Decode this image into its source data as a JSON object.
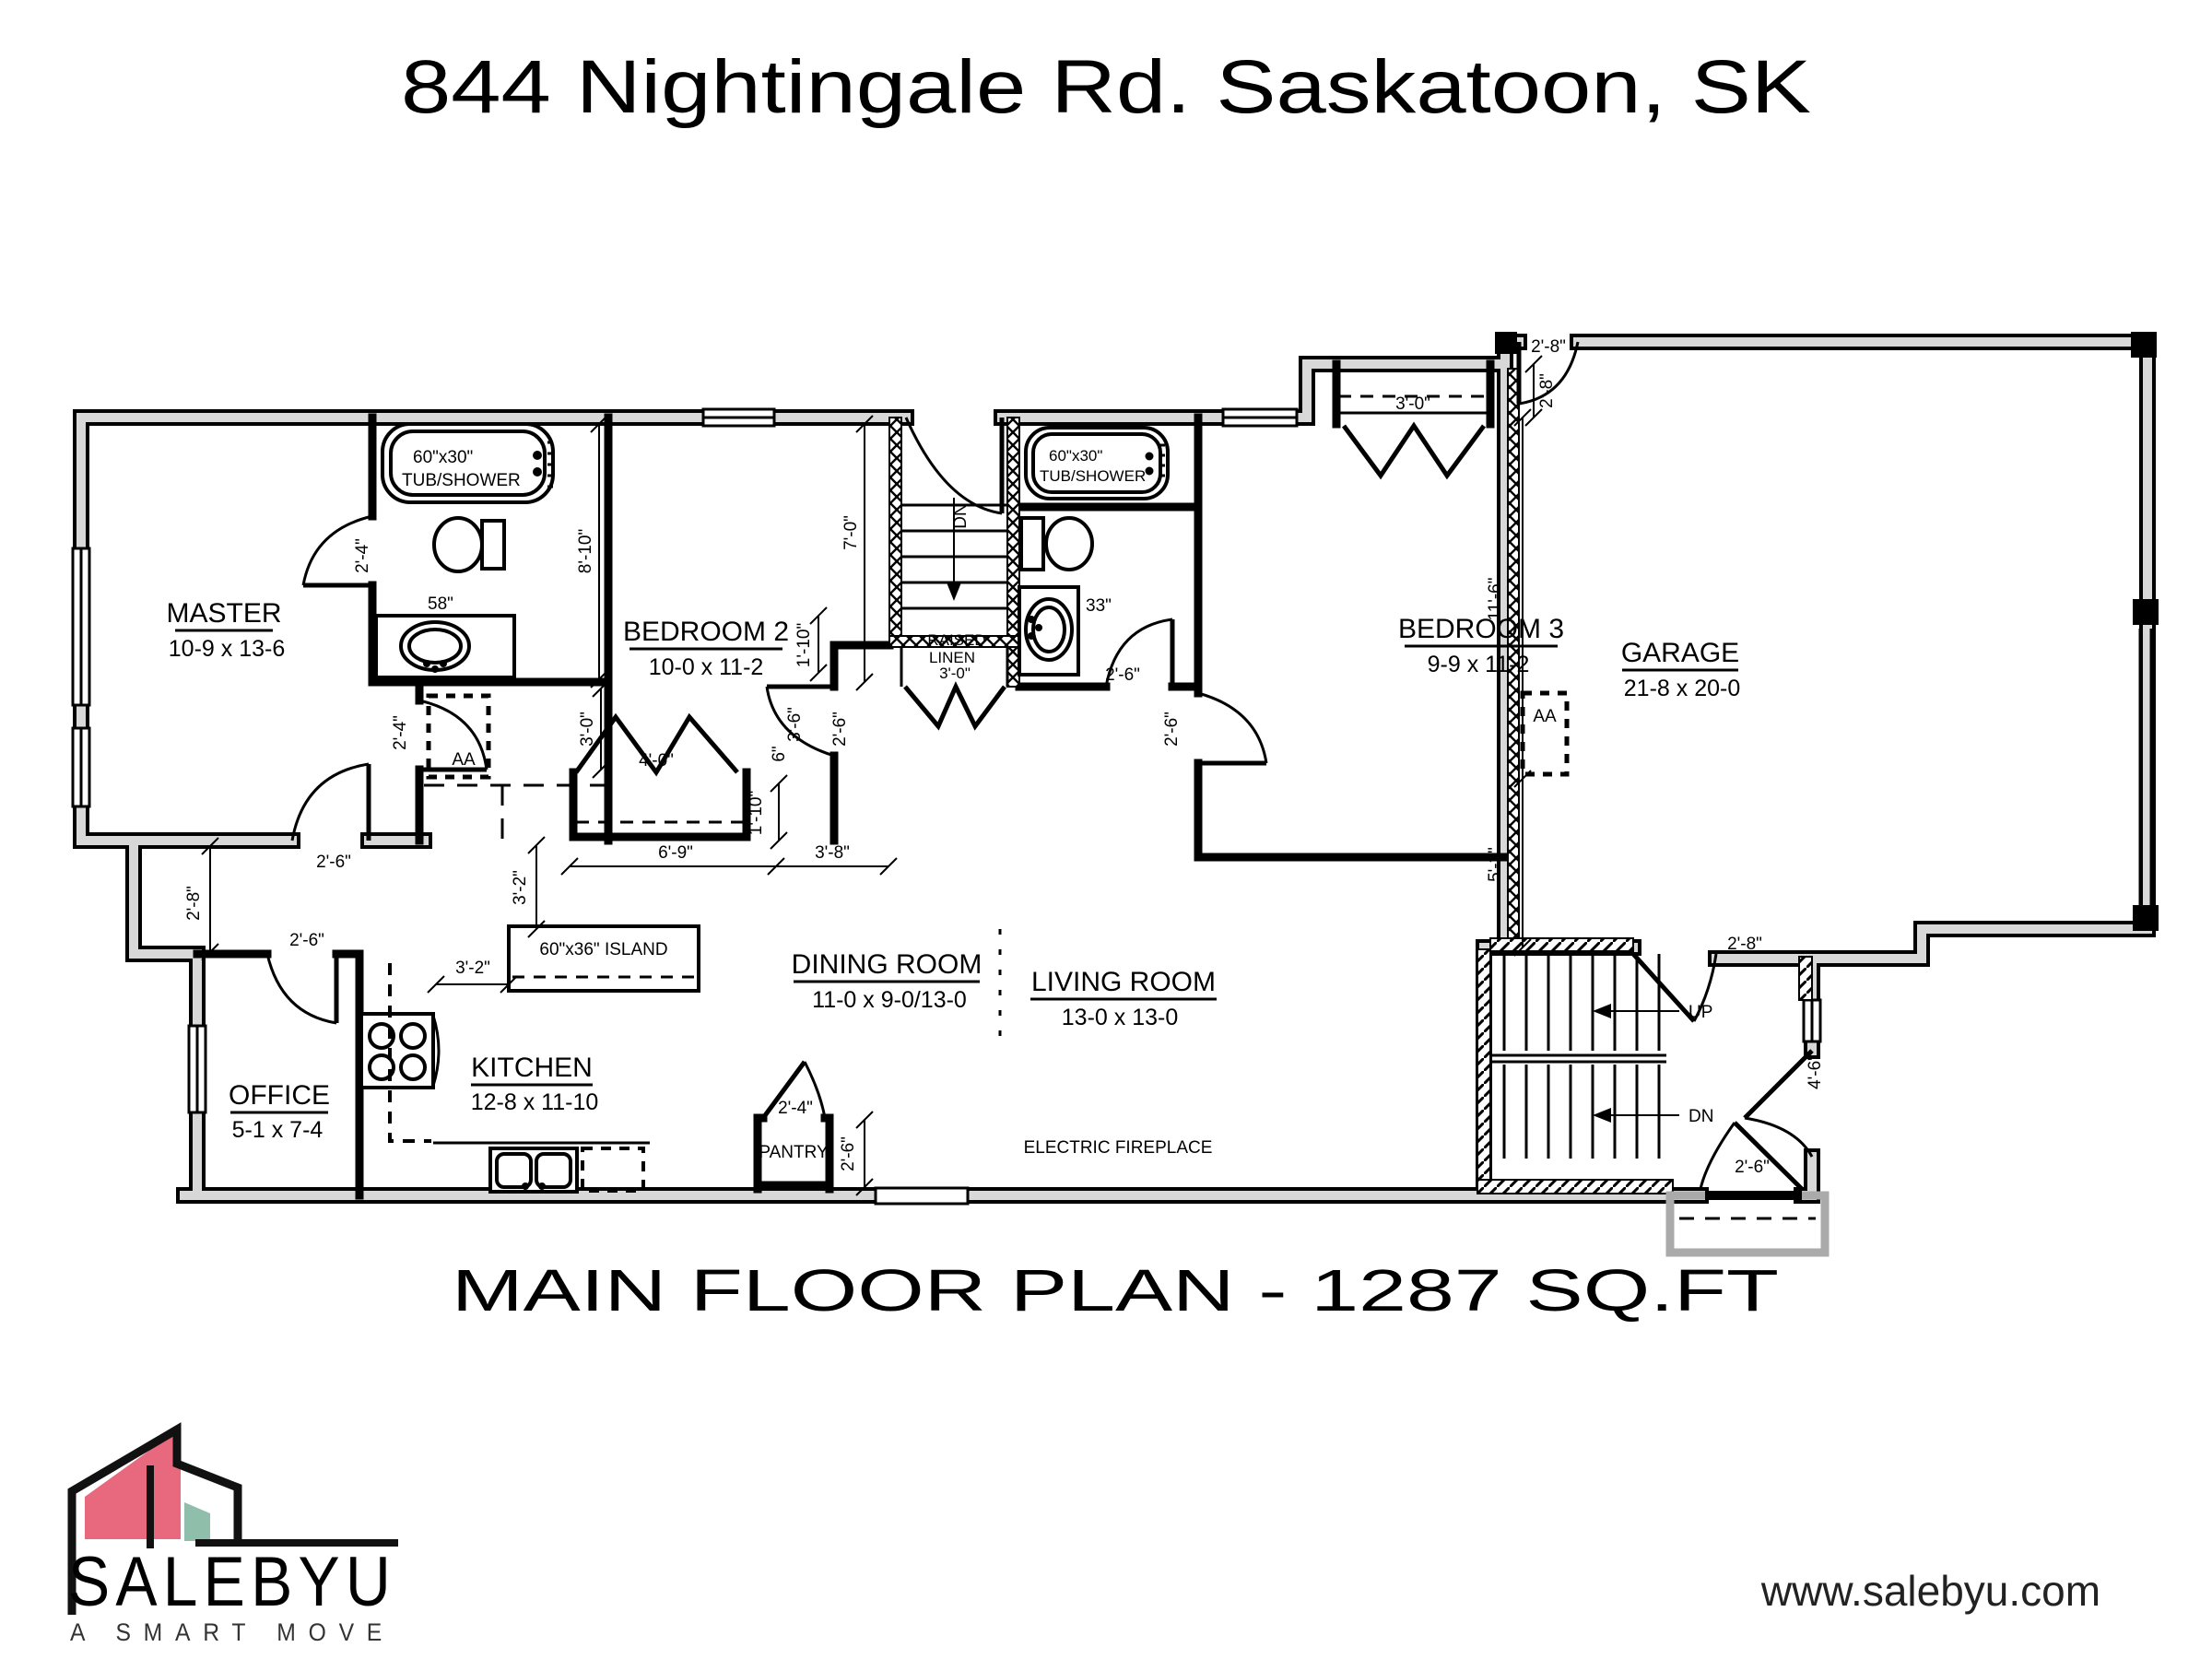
{
  "header": {
    "title": "844 Nightingale Rd. Saskatoon, SK"
  },
  "footer": {
    "plan_title": "MAIN FLOOR PLAN - 1287 SQ.FT",
    "website": "www.salebyu.com"
  },
  "logo": {
    "brand": "SALEBYU",
    "tagline": "A SMART MOVE",
    "accent_pink": "#e8697d",
    "accent_teal": "#8fbfab"
  },
  "rooms": {
    "master": {
      "name": "MASTER",
      "dims": "10-9 x 13-6"
    },
    "bedroom2": {
      "name": "BEDROOM 2",
      "dims": "10-0 x 11-2"
    },
    "bedroom3": {
      "name": "BEDROOM 3",
      "dims": "9-9 x 11-2"
    },
    "garage": {
      "name": "GARAGE",
      "dims": "21-8 x 20-0"
    },
    "office": {
      "name": "OFFICE",
      "dims": "5-1 x 7-4"
    },
    "kitchen": {
      "name": "KITCHEN",
      "dims": "12-8 x 11-10"
    },
    "dining": {
      "name": "DINING ROOM",
      "dims": "11-0 x 9-0/13-0"
    },
    "living": {
      "name": "LIVING ROOM",
      "dims": "13-0 x 13-0"
    },
    "pantry": {
      "name": "PANTRY"
    },
    "linen": {
      "line1": "RAISED",
      "line2": "LINEN",
      "width": "3'-0\""
    }
  },
  "fixtures": {
    "tub_master_l1": "60\"x30\"",
    "tub_master_l2": "TUB/SHOWER",
    "tub_main_l1": "60\"x30\"",
    "tub_main_l2": "TUB/SHOWER",
    "vanity_master": "58\"",
    "vanity_main": "33\"",
    "island": "60\"x36\" ISLAND",
    "fireplace": "ELECTRIC FIREPLACE",
    "attic_access_closet": "AA",
    "attic_access_garage": "AA",
    "stairs_up": "UP",
    "stairs_dn": "DN",
    "stairs_dn_top": "DN"
  },
  "dims": {
    "ensuite_door": "2'-4\"",
    "closet_door": "2'-4\"",
    "pantry_door": "2'-4\"",
    "master_door": "2'-6\"",
    "office_door": "2'-6\"",
    "bed2_door": "2'-6\"",
    "bath_main_door": "2'-6\"",
    "bed3_door": "2'-6\"",
    "pantry_depth": "2'-6\"",
    "entry_door": "2'-6\"",
    "hall_jog": "2'-8\"",
    "garage_man_door": "2'-8\"",
    "garage_entry_door": "2'-8\"",
    "bed3_closet_side": "2'-8\"",
    "ensuite_width": "8'-10\"",
    "stair_hall": "7'-0\"",
    "bed2_closet_depth": "3'-0\"",
    "bed3_closet_width": "3'-0\"",
    "bed2_closet_width": "4'-0\"",
    "hall_a": "1'-10\"",
    "hall_b": "1'-10\"",
    "hall_c": "3'-6\"",
    "hall_d": "6\"",
    "closet_run": "6'-9\"",
    "closet_run2": "3'-8\"",
    "kitchen_aisle": "3'-2\"",
    "kitchen_aisle2": "3'-2\"",
    "garage_side_a": "11'-6\"",
    "garage_side_b": "5'-2\"",
    "entry_side": "4'-6\""
  }
}
